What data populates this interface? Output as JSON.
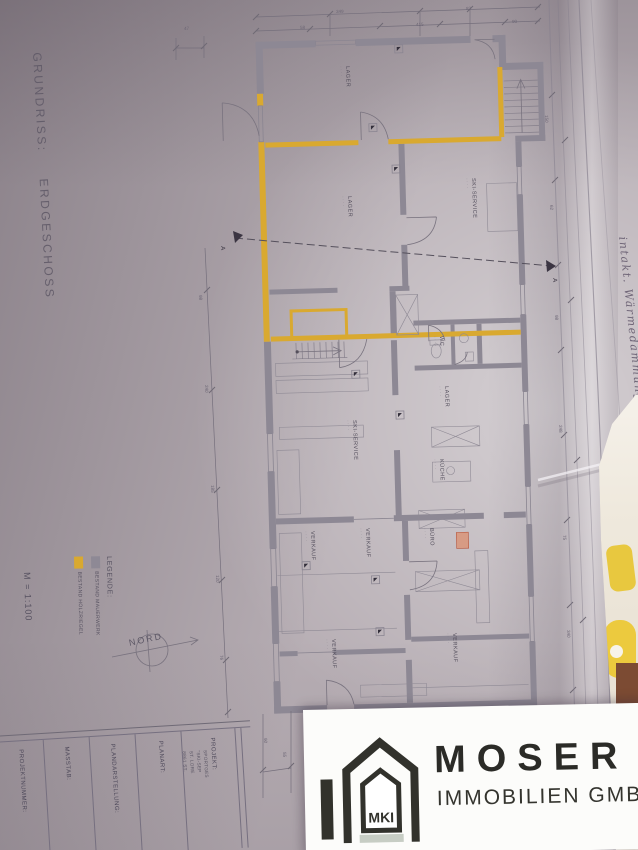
{
  "page": {
    "side_title": "GRUNDRISS:",
    "side_subtitle": "ERDGESCHOSS"
  },
  "plan": {
    "north_label": "NORD",
    "section_marker": "A",
    "room_sub": "· · · ·",
    "rooms": [
      {
        "label": "LAGER",
        "x": 350,
        "y": 66
      },
      {
        "label": "LAGER",
        "x": 352,
        "y": 196
      },
      {
        "label": "SKI-SERVICE",
        "x": 476,
        "y": 178
      },
      {
        "label": "WC",
        "x": 444,
        "y": 336
      },
      {
        "label": "LAGER",
        "x": 449,
        "y": 386
      },
      {
        "label": "SKI-SERVICE",
        "x": 357,
        "y": 420
      },
      {
        "label": "KÜCHE",
        "x": 444,
        "y": 459
      },
      {
        "label": "BÜRO",
        "x": 434,
        "y": 528
      },
      {
        "label": "VERKAUF",
        "x": 315,
        "y": 531
      },
      {
        "label": "VERKAUF",
        "x": 370,
        "y": 528
      },
      {
        "label": "VERKAUF",
        "x": 336,
        "y": 639
      },
      {
        "label": "VERKAUF",
        "x": 457,
        "y": 633
      }
    ],
    "dim_numbers": [
      {
        "t": "349",
        "x": 336,
        "y": 9,
        "r": -2
      },
      {
        "t": "82",
        "x": 466,
        "y": 6,
        "r": -2
      },
      {
        "t": "47",
        "x": 184,
        "y": 26,
        "r": -2
      },
      {
        "t": "58",
        "x": 300,
        "y": 25,
        "r": -2
      },
      {
        "t": "415",
        "x": 416,
        "y": 22,
        "r": -2
      },
      {
        "t": "90",
        "x": 512,
        "y": 19,
        "r": -2
      },
      {
        "t": "98",
        "x": 203,
        "y": 295,
        "r": 88
      },
      {
        "t": "240",
        "x": 209,
        "y": 385,
        "r": 88
      },
      {
        "t": "185",
        "x": 215,
        "y": 485,
        "r": 88
      },
      {
        "t": "120",
        "x": 220,
        "y": 575,
        "r": 88
      },
      {
        "t": "76",
        "x": 224,
        "y": 655,
        "r": 88
      },
      {
        "t": "150",
        "x": 549,
        "y": 115,
        "r": 88
      },
      {
        "t": "62",
        "x": 554,
        "y": 205,
        "r": 88
      },
      {
        "t": "98",
        "x": 559,
        "y": 315,
        "r": 88
      },
      {
        "t": "248",
        "x": 563,
        "y": 425,
        "r": 88
      },
      {
        "t": "75",
        "x": 567,
        "y": 535,
        "r": 88
      },
      {
        "t": "340",
        "x": 571,
        "y": 630,
        "r": 88
      },
      {
        "t": "90",
        "x": 268,
        "y": 738,
        "r": 88
      },
      {
        "t": "55",
        "x": 287,
        "y": 752,
        "r": 88
      }
    ]
  },
  "legend": {
    "heading": "LEGENDE:",
    "items": [
      {
        "label": "BESTAND MAUERWERK",
        "color": "#8e8995"
      },
      {
        "label": "BESTAND HOLZRIEGEL",
        "color": "#d9a930"
      }
    ],
    "scale": "M = 1:100"
  },
  "handwriting": {
    "line1": "intakt. Wärmedämmung",
    "line2": "— o 1"
  },
  "titleblock": {
    "fields": [
      {
        "label": "PROJEKTNUMMER:"
      },
      {
        "label": "MASSTAB:"
      },
      {
        "label": "PLANDARSTELLUNG:"
      },
      {
        "label": "PLANART:"
      },
      {
        "label": "PROJEKT:"
      }
    ],
    "project_lines": [
      "SPORTGES",
      "\"SKI-SEP",
      "ST. LORE",
      "8861 ST."
    ]
  },
  "logo": {
    "badge": "MKI",
    "brand": "MOSER",
    "subtitle": "IMMOBILIEN GMBH"
  }
}
